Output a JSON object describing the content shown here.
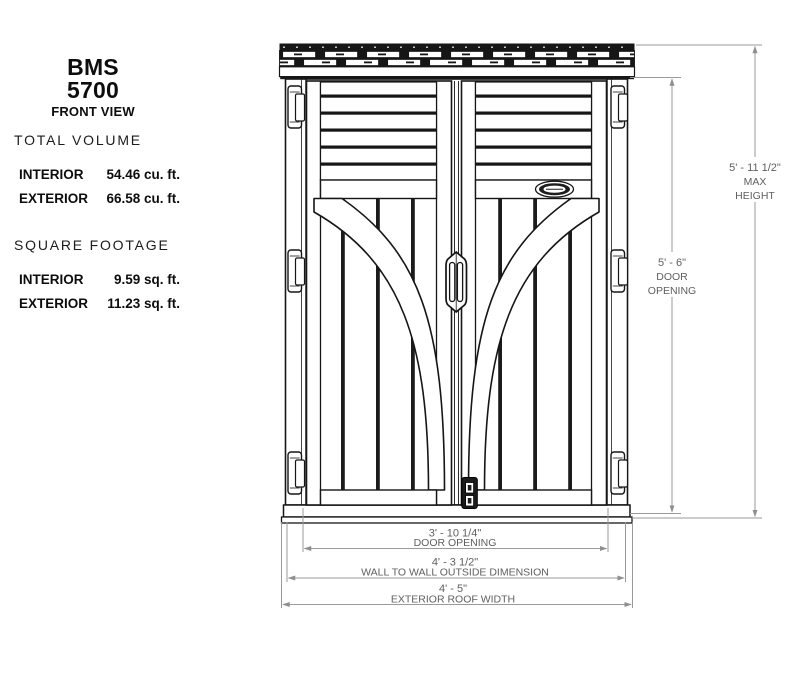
{
  "title_block": {
    "model": "BMS 5700",
    "view_label": "FRONT VIEW"
  },
  "specs": {
    "total_volume": {
      "heading": "TOTAL VOLUME",
      "rows": [
        {
          "label": "INTERIOR",
          "value": "54.46 cu. ft."
        },
        {
          "label": "EXTERIOR",
          "value": "66.58 cu. ft."
        }
      ]
    },
    "square_footage": {
      "heading": "SQUARE FOOTAGE",
      "rows": [
        {
          "label": "INTERIOR",
          "value": "9.59 sq. ft."
        },
        {
          "label": "EXTERIOR",
          "value": "11.23 sq. ft."
        }
      ]
    }
  },
  "drawing": {
    "subject": "storage shed front elevation",
    "dimensions": {
      "max_height": {
        "value": "5' - 11 1/2\"",
        "label_lines": [
          "MAX",
          "HEIGHT"
        ]
      },
      "door_opening_height": {
        "value": "5' - 6\"",
        "label_lines": [
          "DOOR",
          "OPENING"
        ]
      },
      "door_opening_width": {
        "value": "3' - 10 1/4\"",
        "label": "DOOR OPENING"
      },
      "wall_to_wall_width": {
        "value": "4' - 3 1/2\"",
        "label": "WALL TO WALL OUTSIDE DIMENSION"
      },
      "exterior_roof_width": {
        "value": "4' - 5\"",
        "label": "EXTERIOR ROOF WIDTH"
      }
    }
  },
  "colors": {
    "drawing_line": "#1a1a1a",
    "dimension_line": "#8f8f8f",
    "dimension_text": "#5f5f5f",
    "text": "#000000",
    "background": "#ffffff"
  }
}
